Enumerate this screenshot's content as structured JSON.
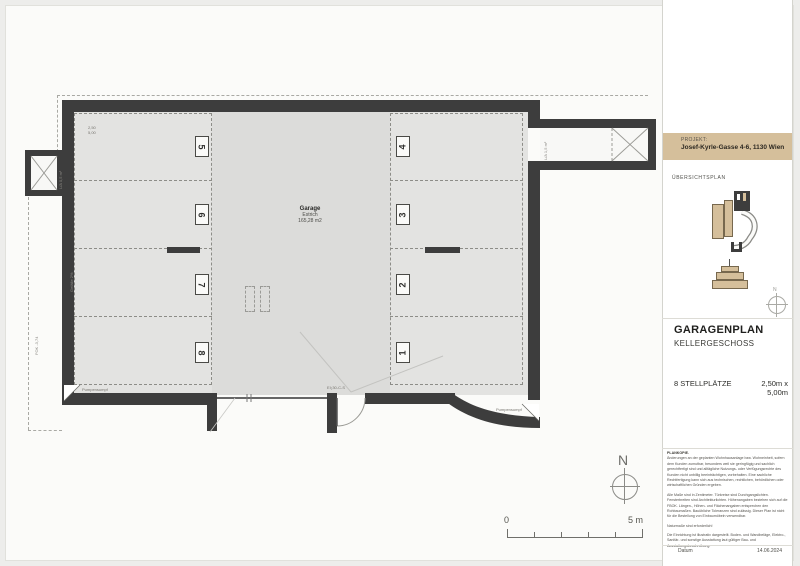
{
  "panel": {
    "project": {
      "label": "PROJEKT:",
      "value": "Josef-Kyrle-Gasse 4-6, 1130 Wien"
    },
    "overview_label": "ÜBERSICHTSPLAN",
    "north_small": "N",
    "title_block": {
      "title": "GARAGENPLAN",
      "subtitle": "KELLERGESCHOSS",
      "stalls_count": "8 STELLPLÄTZE",
      "stall_size": "2,50m x 5,00m"
    },
    "notes": {
      "heading": "PLANKOPIE.",
      "p1": "Änderungen an der geplanten Wohnhausanlage bzw. Wohneinheit, sofern dem Kunden zumutbar, besonders weil sie geringfügig und sachlich gerechtfertigt sind und alltägliche Nutzungs- oder Verfügungsrechte des Kunden nicht unbillig beeinträchtigen, vorbehalten. Eine sachliche Rechtfertigung kann sich aus technischen, rechtlichen, behördlichen oder wirtschaftlichen Gründen ergeben.",
      "p2": "Alle Maße sind in Zentimeter. Türkreise sind Durchgangslichten. Fensterbreiten sind Architekturlichten. Höhenangaben beziehen sich auf die FBOK. Längen-, Höhen- und Flächenangaben entsprechen den Rohbaumaßen. Bauübliche Toleranzen sind zulässig. Dieser Plan ist nicht für die Bestellung von Einbaumöbeln verwendbar.",
      "p3": "Naturmaße sind erforderlich!",
      "p4": "Die Einrichtung ist illustrativ dargestellt. Boden- und Wandbeläge, Elektro-, Sanitär- und sonstige Ausstattung laut gültiger Bau- und Ausstattungsbeschreibung."
    },
    "footer": {
      "date_label": "Datum",
      "date_value": "14.06.2024"
    }
  },
  "plan": {
    "room": {
      "name": "Garage",
      "floor": "Estrich",
      "area": "165,28 m2"
    },
    "stalls_left": [
      "5",
      "6",
      "7",
      "8"
    ],
    "stalls_right": [
      "4",
      "3",
      "2",
      "1"
    ],
    "stall_dims": {
      "width": "2,50",
      "depth": "5,00"
    },
    "door_label": "EI₂30-C-S",
    "annotations": {
      "slope": "Gefälle 2%",
      "level": "FOK -3,74",
      "shaft_left": "L/A 0,5 m²",
      "shaft_right": "L/A 1,5 m²",
      "sump_left": "Pumpensumpf",
      "sump_right": "Pumpensumpf"
    },
    "north_label": "N",
    "scale": {
      "start": "0",
      "end": "5 m"
    }
  },
  "colors": {
    "wall": "#3d3d3d",
    "floor": "#e3e3e1",
    "aisle": "#dcdcda",
    "accent_tan": "#d5bf9b"
  }
}
